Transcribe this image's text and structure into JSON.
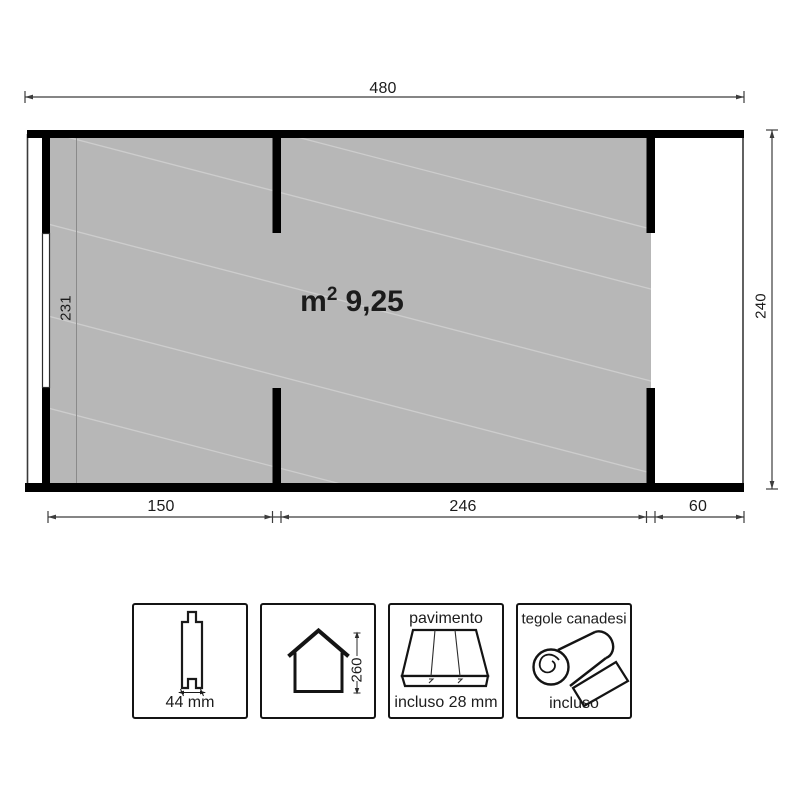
{
  "drawing": {
    "area": {
      "unit": "m",
      "exponent": "2",
      "value": "9,25"
    },
    "dims": {
      "width_total": "480",
      "height_total": "240",
      "interior_height": "231",
      "seg_left": "150",
      "seg_middle": "246",
      "seg_right": "60"
    },
    "colors": {
      "wall": "#000000",
      "floor_fill": "#b7b7b7",
      "texture_line": "#cdcdcd",
      "dim_line": "#3c3c3c",
      "text": "#1c1c1c"
    }
  },
  "legend": {
    "plank": {
      "icon": "plank-profile-icon",
      "value": "44 mm"
    },
    "house": {
      "icon": "house-icon",
      "value": "260"
    },
    "floor": {
      "icon": "floor-planks-icon",
      "title": "pavimento",
      "value": "incluso 28 mm"
    },
    "shingles": {
      "icon": "roofing-roll-icon",
      "title": "tegole canadesi",
      "value": "incluso"
    }
  }
}
